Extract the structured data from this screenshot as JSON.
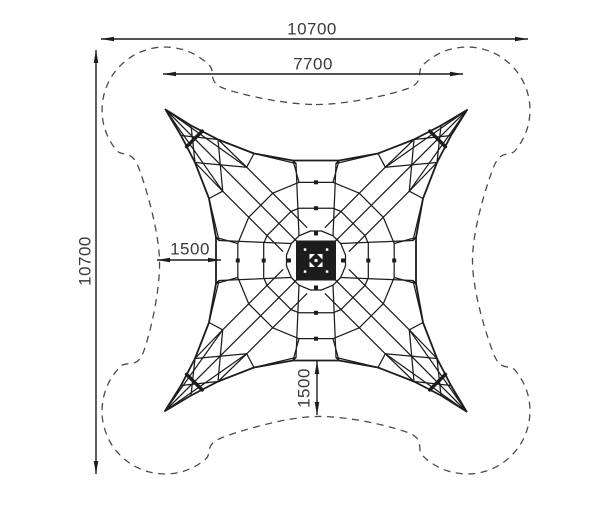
{
  "meta": {
    "title": "Space net climber - plan view with safety zone",
    "units": "mm"
  },
  "canvas": {
    "w": 600,
    "h": 519,
    "bg": "#ffffff"
  },
  "style": {
    "line_color": "#1c1c1c",
    "dashed_color": "#4b4b4b",
    "text_color": "#3a3a3a",
    "font_size": 17
  },
  "dimensions": [
    {
      "name": "overall-width",
      "value": "10700",
      "type": "h",
      "y": 39,
      "x1": 101,
      "x2": 528,
      "lx": 312,
      "ly": 29,
      "rot": false
    },
    {
      "name": "net-width",
      "value": "7700",
      "type": "h",
      "y": 74,
      "x1": 163,
      "x2": 463,
      "lx": 313,
      "ly": 64,
      "rot": false
    },
    {
      "name": "overall-height",
      "value": "10700",
      "type": "v",
      "x": 96,
      "y1": 50,
      "y2": 474,
      "lx": 85,
      "ly": 261,
      "rot": true
    },
    {
      "name": "side-clearance",
      "value": "1500",
      "type": "h",
      "y": 260,
      "x1": 157,
      "x2": 221,
      "lx": 190,
      "ly": 249,
      "rot": false
    },
    {
      "name": "bottom-clearance",
      "value": "1500",
      "type": "v",
      "x": 317,
      "y1": 361,
      "y2": 415,
      "lx": 304,
      "ly": 388,
      "rot": true
    }
  ],
  "structure": {
    "center": {
      "x": 316,
      "y": 260.5
    },
    "tip_offset": 151,
    "tip_offset_y": 150.5,
    "waist_radius": 100,
    "waist_half": 23,
    "ring_radii": [
      30,
      55,
      80
    ],
    "corridor_half": 17,
    "safety_bulge_radius": 63,
    "safety_waist_radius": 156
  }
}
